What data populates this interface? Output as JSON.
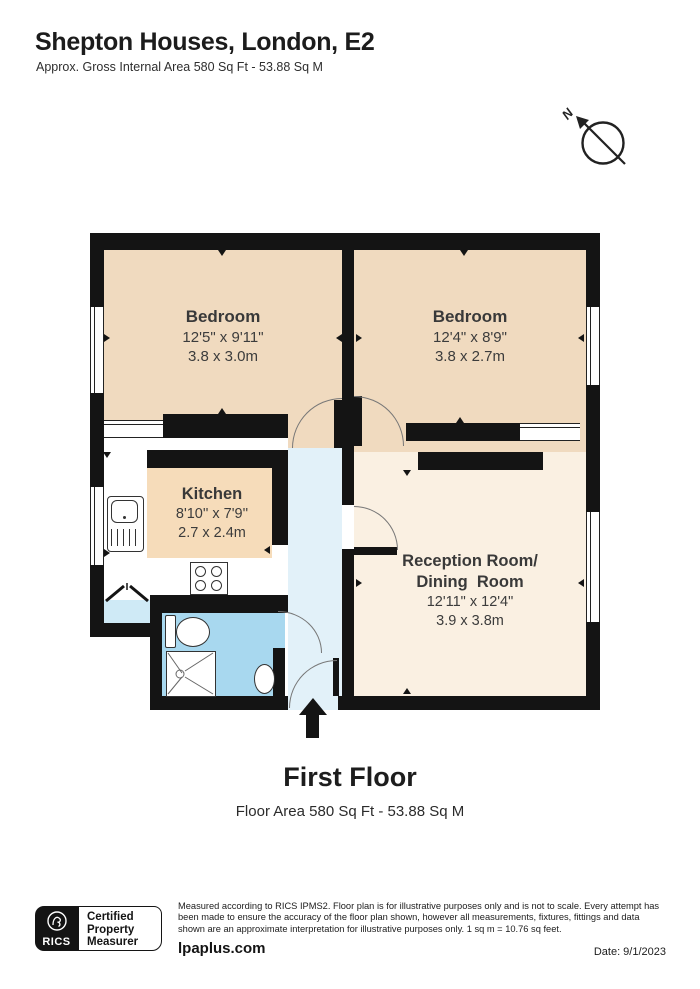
{
  "header": {
    "title": "Shepton Houses, London, E2",
    "subtitle": "Approx. Gross Internal Area 580 Sq Ft - 53.88 Sq M"
  },
  "compass": {
    "label": "N"
  },
  "rooms": {
    "bedroom_left": {
      "name": "Bedroom",
      "dims_imperial": "12'5\" x 9'11\"",
      "dims_metric": "3.8 x 3.0m"
    },
    "bedroom_right": {
      "name": "Bedroom",
      "dims_imperial": "12'4\" x 8'9\"",
      "dims_metric": "3.8 x 2.7m"
    },
    "kitchen": {
      "name": "Kitchen",
      "dims_imperial": "8'10'' x 7'9''",
      "dims_metric": "2.7 x 2.4m"
    },
    "reception": {
      "name_line1": "Reception Room/",
      "name_line2": "Dining  Room",
      "dims_imperial": "12'11\" x 12'4\"",
      "dims_metric": "3.9 x 3.8m"
    }
  },
  "fixtures": [
    "sink",
    "hob",
    "toilet",
    "shower",
    "basin",
    "entrance-arrow",
    "compass"
  ],
  "floor_label": {
    "title": "First Floor",
    "subtitle": "Floor Area 580 Sq Ft - 53.88 Sq M"
  },
  "footer": {
    "rics_label": "RICS",
    "badge_lines": [
      "Certified",
      "Property",
      "Measurer"
    ],
    "disclaimer": "Measured according to RICS IPMS2. Floor plan is for illustrative purposes only and is not to scale. Every attempt has been made to ensure the accuracy of the floor plan shown, however all measurements, fixtures, fittings and data shown are an approximate interpretation for illustrative purposes only. 1 sq m = 10.76 sq feet.",
    "website": "lpaplus.com",
    "date": "Date: 9/1/2023"
  },
  "colors": {
    "wall": "#141414",
    "bedroom": "#f0dabf",
    "kitchen_floor": "#f6dcba",
    "reception": "#faf0e2",
    "bathroom": "#a8d8ef",
    "hallway": "#e2f1f9",
    "lobby": "#cfeaf6"
  }
}
